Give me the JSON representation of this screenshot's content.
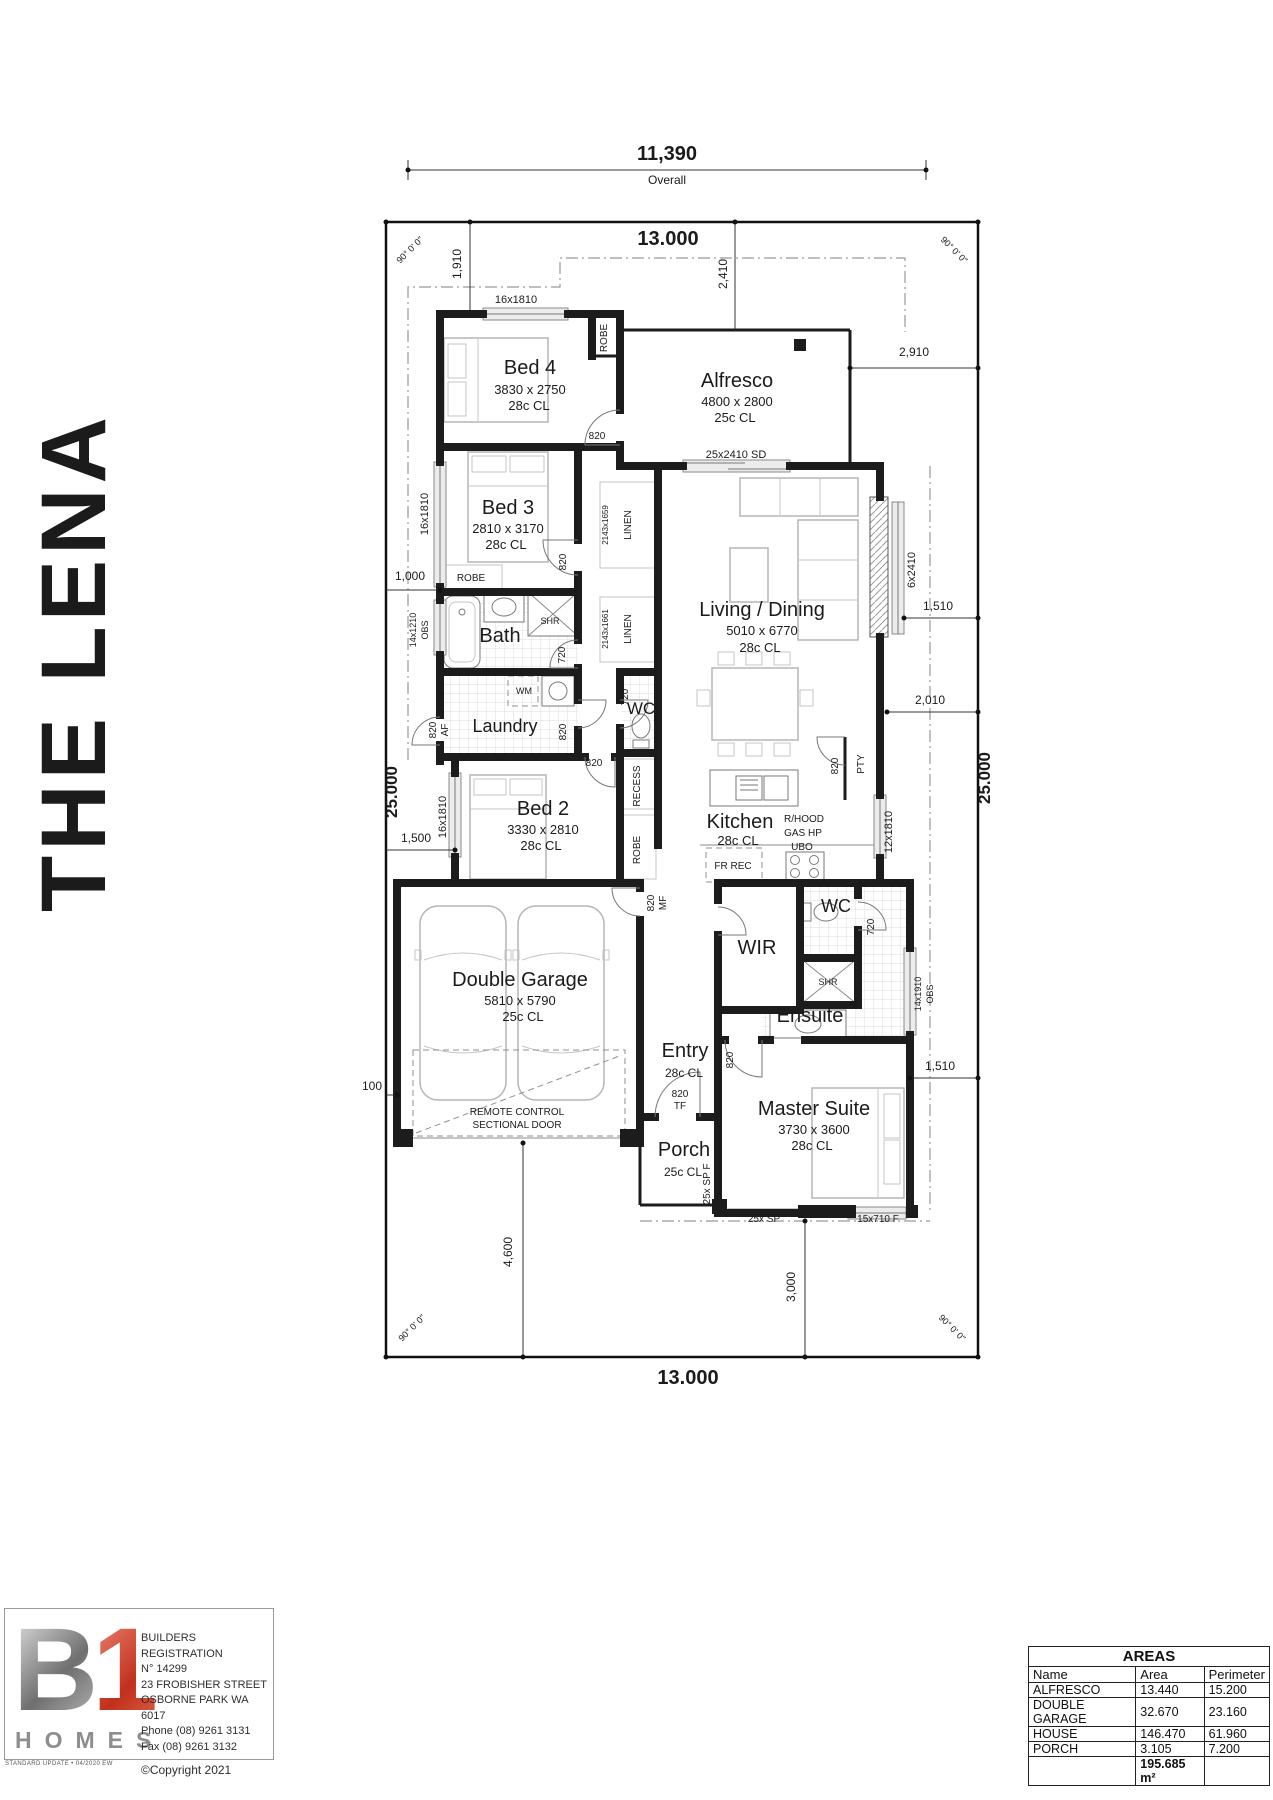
{
  "title": {
    "text": "THE LENA"
  },
  "colors": {
    "wall": "#1c1c1c",
    "logo_red": "#c1301c",
    "logo_gray": "#8e8e8e"
  },
  "logo": {
    "b": "B",
    "one": "1",
    "homes": "HOMES",
    "lines": [
      "BUILDERS REGISTRATION",
      "N° 14299",
      "23 FROBISHER STREET",
      "OSBORNE PARK  WA  6017",
      "Phone (08) 9261 3131",
      "Fax (08) 9261 3132"
    ],
    "copyright": "©Copyright 2021",
    "footnote": "STANDARD UPDATE • 04/2020 EW"
  },
  "areas_table": {
    "title": "AREAS",
    "headers": [
      "Name",
      "Area",
      "Perimeter"
    ],
    "rows": [
      [
        "ALFRESCO",
        "13.440",
        "15.200"
      ],
      [
        "DOUBLE GARAGE",
        "32.670",
        "23.160"
      ],
      [
        "HOUSE",
        "146.470",
        "61.960"
      ],
      [
        "PORCH",
        "3.105",
        "7.200"
      ]
    ],
    "total_area": "195.685 m²"
  },
  "plan": {
    "labels": [
      {
        "id": "dim-overall",
        "t": "11,390",
        "x": 667,
        "y": 160,
        "s": 20,
        "w": "b"
      },
      {
        "id": "dim-overall-caption",
        "t": "Overall",
        "x": 667,
        "y": 184,
        "s": 12
      },
      {
        "id": "dim-top-13000",
        "t": "13.000",
        "x": 668,
        "y": 245,
        "s": 20,
        "w": "b"
      },
      {
        "id": "angle-top-left",
        "t": "90° 0' 0\"",
        "x": 412,
        "y": 252,
        "r": -45,
        "s": 9
      },
      {
        "id": "angle-top-right",
        "t": "90° 0' 0\"",
        "x": 952,
        "y": 252,
        "r": 45,
        "s": 9
      },
      {
        "id": "dim-1910",
        "t": "1,910",
        "x": 461,
        "y": 264,
        "r": -90,
        "s": 12
      },
      {
        "id": "dim-2410",
        "t": "2,410",
        "x": 727,
        "y": 274,
        "r": -90,
        "s": 12
      },
      {
        "id": "dim-2910",
        "t": "2,910",
        "x": 914,
        "y": 356,
        "s": 12
      },
      {
        "id": "dim-25000-left",
        "t": "25.000",
        "x": 397,
        "y": 792,
        "r": -90,
        "s": 17,
        "w": "b"
      },
      {
        "id": "dim-25000-right",
        "t": "25.000",
        "x": 990,
        "y": 778,
        "r": -90,
        "s": 17,
        "w": "b"
      },
      {
        "id": "dim-1510-upper",
        "t": "1,510",
        "x": 938,
        "y": 610,
        "s": 12
      },
      {
        "id": "dim-2010",
        "t": "2,010",
        "x": 930,
        "y": 704,
        "s": 12
      },
      {
        "id": "dim-1000",
        "t": "1,000",
        "x": 410,
        "y": 580,
        "s": 12
      },
      {
        "id": "dim-1500",
        "t": "1,500",
        "x": 416,
        "y": 842,
        "s": 12
      },
      {
        "id": "dim-100",
        "t": "100",
        "x": 372,
        "y": 1090,
        "s": 12
      },
      {
        "id": "dim-1510-lower",
        "t": "1,510",
        "x": 940,
        "y": 1070,
        "s": 12
      },
      {
        "id": "dim-4600",
        "t": "4,600",
        "x": 512,
        "y": 1252,
        "r": -90,
        "s": 12
      },
      {
        "id": "dim-3000",
        "t": "3,000",
        "x": 795,
        "y": 1287,
        "r": -90,
        "s": 12
      },
      {
        "id": "dim-bottom-13000",
        "t": "13.000",
        "x": 688,
        "y": 1384,
        "s": 20,
        "w": "b"
      },
      {
        "id": "angle-bottom-left",
        "t": "90° 0' 0\"",
        "x": 414,
        "y": 1330,
        "r": -45,
        "s": 9
      },
      {
        "id": "angle-bottom-right",
        "t": "90° 0' 0\"",
        "x": 950,
        "y": 1330,
        "r": 45,
        "s": 9
      },
      {
        "id": "bed4-name",
        "t": "Bed 4",
        "x": 530,
        "y": 374,
        "s": 20
      },
      {
        "id": "bed4-size",
        "t": "3830 x 2750",
        "x": 530,
        "y": 394,
        "s": 13
      },
      {
        "id": "bed4-ceiling",
        "t": "28c CL",
        "x": 529,
        "y": 410,
        "s": 13
      },
      {
        "id": "alfresco-name",
        "t": "Alfresco",
        "x": 737,
        "y": 387,
        "s": 20
      },
      {
        "id": "alfresco-size",
        "t": "4800 x 2800",
        "x": 737,
        "y": 406,
        "s": 13
      },
      {
        "id": "alfresco-ceiling",
        "t": "25c CL",
        "x": 735,
        "y": 422,
        "s": 13
      },
      {
        "id": "bed3-name",
        "t": "Bed 3",
        "x": 508,
        "y": 514,
        "s": 20
      },
      {
        "id": "bed3-size",
        "t": "2810 x 3170",
        "x": 508,
        "y": 533,
        "s": 13
      },
      {
        "id": "bed3-ceiling",
        "t": "28c CL",
        "x": 506,
        "y": 549,
        "s": 13
      },
      {
        "id": "living-name",
        "t": "Living / Dining",
        "x": 762,
        "y": 616,
        "s": 20
      },
      {
        "id": "living-size",
        "t": "5010 x 6770",
        "x": 762,
        "y": 635,
        "s": 13
      },
      {
        "id": "living-ceiling",
        "t": "28c CL",
        "x": 760,
        "y": 652,
        "s": 13
      },
      {
        "id": "kitchen-name",
        "t": "Kitchen",
        "x": 740,
        "y": 828,
        "s": 20
      },
      {
        "id": "kitchen-ceiling",
        "t": "28c CL",
        "x": 738,
        "y": 845,
        "s": 13
      },
      {
        "id": "rhood",
        "t": "R/HOOD",
        "x": 804,
        "y": 822,
        "s": 10
      },
      {
        "id": "gas-hp",
        "t": "GAS HP",
        "x": 803,
        "y": 836,
        "s": 10
      },
      {
        "id": "ubo",
        "t": "UBO",
        "x": 802,
        "y": 850,
        "s": 10
      },
      {
        "id": "bed2-name",
        "t": "Bed 2",
        "x": 543,
        "y": 815,
        "s": 20
      },
      {
        "id": "bed2-size",
        "t": "3330 x 2810",
        "x": 543,
        "y": 834,
        "s": 13
      },
      {
        "id": "bed2-ceiling",
        "t": "28c CL",
        "x": 541,
        "y": 850,
        "s": 13
      },
      {
        "id": "garage-name",
        "t": "Double Garage",
        "x": 520,
        "y": 986,
        "s": 20
      },
      {
        "id": "garage-size",
        "t": "5810 x 5790",
        "x": 520,
        "y": 1005,
        "s": 13
      },
      {
        "id": "garage-ceiling",
        "t": "25c CL",
        "x": 523,
        "y": 1021,
        "s": 13
      },
      {
        "id": "wir-name",
        "t": "WIR",
        "x": 757,
        "y": 954,
        "s": 20
      },
      {
        "id": "ensuite-name",
        "t": "Ensuite",
        "x": 810,
        "y": 1022,
        "s": 20
      },
      {
        "id": "master-name",
        "t": "Master Suite",
        "x": 814,
        "y": 1115,
        "s": 20
      },
      {
        "id": "master-size",
        "t": "3730 x 3600",
        "x": 814,
        "y": 1134,
        "s": 13
      },
      {
        "id": "master-ceiling",
        "t": "28c CL",
        "x": 812,
        "y": 1150,
        "s": 13
      },
      {
        "id": "entry-name",
        "t": "Entry",
        "x": 685,
        "y": 1057,
        "s": 20
      },
      {
        "id": "entry-ceiling",
        "t": "28c CL",
        "x": 684,
        "y": 1077,
        "s": 12
      },
      {
        "id": "porch-name",
        "t": "Porch",
        "x": 684,
        "y": 1156,
        "s": 20
      },
      {
        "id": "porch-ceiling",
        "t": "25c CL",
        "x": 683,
        "y": 1176,
        "s": 12
      },
      {
        "id": "bath-name",
        "t": "Bath",
        "x": 500,
        "y": 642,
        "s": 20
      },
      {
        "id": "laundry-name",
        "t": "Laundry",
        "x": 505,
        "y": 732,
        "s": 18
      },
      {
        "id": "wc-name",
        "t": "WC",
        "x": 641,
        "y": 714,
        "s": 17
      },
      {
        "id": "wc2-name",
        "t": "WC",
        "x": 836,
        "y": 912,
        "s": 18
      },
      {
        "id": "shr-bath",
        "t": "SHR",
        "x": 550,
        "y": 624,
        "s": 9
      },
      {
        "id": "shr-ensuite",
        "t": "SHR",
        "x": 828,
        "y": 985,
        "s": 9
      },
      {
        "id": "wm",
        "t": "WM",
        "x": 524,
        "y": 694,
        "s": 9
      },
      {
        "id": "robe-bed4",
        "t": "ROBE",
        "x": 607,
        "y": 338,
        "r": -90,
        "s": 10
      },
      {
        "id": "robe-bed3",
        "t": "ROBE",
        "x": 471,
        "y": 581,
        "s": 10
      },
      {
        "id": "robe-hall",
        "t": "ROBE",
        "x": 640,
        "y": 850,
        "r": -90,
        "s": 10
      },
      {
        "id": "linen1-size",
        "t": "2143x1659",
        "x": 608,
        "y": 525,
        "r": -90,
        "s": 8
      },
      {
        "id": "linen1",
        "t": "LINEN",
        "x": 631,
        "y": 525,
        "r": -90,
        "s": 10
      },
      {
        "id": "linen2-size",
        "t": "2143x1661",
        "x": 608,
        "y": 629,
        "r": -90,
        "s": 8
      },
      {
        "id": "linen2",
        "t": "LINEN",
        "x": 631,
        "y": 629,
        "r": -90,
        "s": 10
      },
      {
        "id": "recess",
        "t": "RECESS",
        "x": 640,
        "y": 786,
        "r": -90,
        "s": 10
      },
      {
        "id": "pty",
        "t": "PTY",
        "x": 864,
        "y": 764,
        "r": -90,
        "s": 10
      },
      {
        "id": "fr-rec",
        "t": "FR REC",
        "x": 733,
        "y": 869,
        "s": 10
      },
      {
        "id": "garage-door-line1",
        "t": "REMOTE CONTROL",
        "x": 517,
        "y": 1115,
        "s": 10
      },
      {
        "id": "garage-door-line2",
        "t": "SECTIONAL DOOR",
        "x": 517,
        "y": 1128,
        "s": 10
      },
      {
        "id": "win-bed4",
        "t": "16x1810",
        "x": 516,
        "y": 303,
        "s": 11
      },
      {
        "id": "win-bed3",
        "t": "16x1810",
        "x": 428,
        "y": 514,
        "r": -90,
        "s": 11
      },
      {
        "id": "win-bath-size",
        "t": "14x1210",
        "x": 416,
        "y": 630,
        "r": -90,
        "s": 9
      },
      {
        "id": "win-bath-obs",
        "t": "OBS",
        "x": 428,
        "y": 630,
        "r": -90,
        "s": 9
      },
      {
        "id": "win-bed2",
        "t": "16x1810",
        "x": 446,
        "y": 817,
        "r": -90,
        "s": 11
      },
      {
        "id": "win-alfresco-sd",
        "t": "25x2410 SD",
        "x": 736,
        "y": 458,
        "s": 11
      },
      {
        "id": "win-living",
        "t": "6x2410",
        "x": 915,
        "y": 570,
        "r": -90,
        "s": 11
      },
      {
        "id": "win-kitchen",
        "t": "12x1810",
        "x": 892,
        "y": 832,
        "r": -90,
        "s": 11
      },
      {
        "id": "win-ensuite-size",
        "t": "14x1910",
        "x": 921,
        "y": 994,
        "r": -90,
        "s": 9
      },
      {
        "id": "win-ensuite-obs",
        "t": "OBS",
        "x": 933,
        "y": 994,
        "r": -90,
        "s": 9
      },
      {
        "id": "win-master",
        "t": "15x710 F",
        "x": 878,
        "y": 1222,
        "s": 10
      },
      {
        "id": "screen-porch-side",
        "t": "25x SP F",
        "x": 710,
        "y": 1184,
        "r": -90,
        "s": 10
      },
      {
        "id": "screen-front",
        "t": "25x SP",
        "x": 764,
        "y": 1222,
        "s": 10
      },
      {
        "id": "door-bed4",
        "t": "820",
        "x": 597,
        "y": 439,
        "s": 10
      },
      {
        "id": "door-bed3",
        "t": "820",
        "x": 566,
        "y": 562,
        "r": -90,
        "s": 10
      },
      {
        "id": "door-bath",
        "t": "720",
        "x": 565,
        "y": 655,
        "r": -90,
        "s": 10
      },
      {
        "id": "door-laundry-ext1",
        "t": "820",
        "x": 436,
        "y": 730,
        "r": -90,
        "s": 10
      },
      {
        "id": "door-laundry-ext2",
        "t": "AF",
        "x": 448,
        "y": 730,
        "r": -90,
        "s": 10
      },
      {
        "id": "door-laundry",
        "t": "820",
        "x": 566,
        "y": 732,
        "r": -90,
        "s": 10
      },
      {
        "id": "door-wc",
        "t": "720",
        "x": 628,
        "y": 697,
        "r": -90,
        "s": 10
      },
      {
        "id": "door-hall",
        "t": "820",
        "x": 594,
        "y": 766,
        "s": 10
      },
      {
        "id": "door-pantry",
        "t": "820",
        "x": 838,
        "y": 766,
        "r": -90,
        "s": 10
      },
      {
        "id": "door-garage1",
        "t": "820",
        "x": 654,
        "y": 903,
        "r": -90,
        "s": 10
      },
      {
        "id": "door-garage2",
        "t": "MF",
        "x": 666,
        "y": 903,
        "r": -90,
        "s": 10
      },
      {
        "id": "door-wc2",
        "t": "720",
        "x": 874,
        "y": 927,
        "r": -90,
        "s": 10
      },
      {
        "id": "door-master",
        "t": "820",
        "x": 733,
        "y": 1060,
        "r": -90,
        "s": 10
      },
      {
        "id": "door-entry1",
        "t": "820",
        "x": 680,
        "y": 1097,
        "s": 10
      },
      {
        "id": "door-entry2",
        "t": "TF",
        "x": 680,
        "y": 1109,
        "s": 10
      }
    ]
  }
}
